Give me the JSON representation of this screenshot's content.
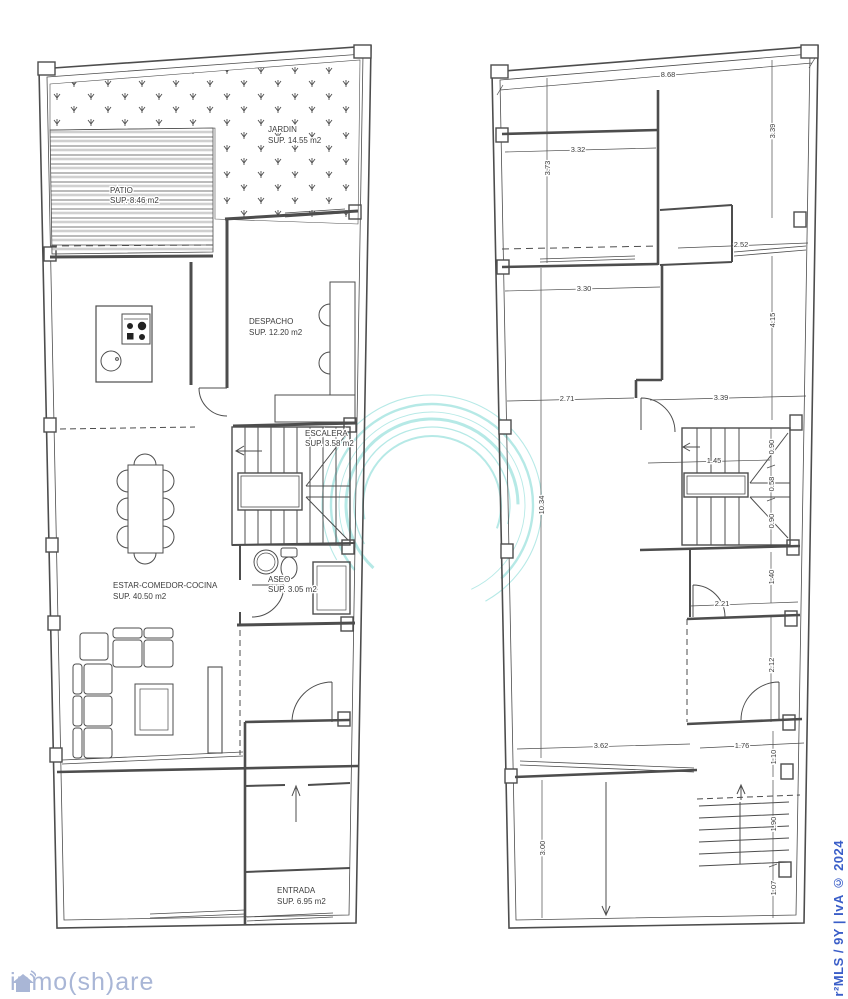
{
  "sheet": {
    "background": "#ffffff"
  },
  "branding": {
    "logo_text": "inmo(sh)are",
    "logo_color": "#a9b6d6",
    "credit_text": "r²MLS / 9Y | IvA © 2024",
    "credit_color": "#3a5ec8",
    "swirl_color": "#6fd4cf"
  },
  "ground_floor": {
    "rooms": {
      "patio": {
        "name": "PATIO",
        "area": "SUP. 8.46 m2"
      },
      "jardin": {
        "name": "JARDIN",
        "area": "SUP. 14.55 m2"
      },
      "despacho": {
        "name": "DESPACHO",
        "area": "SUP. 12.20 m2"
      },
      "escalera": {
        "name": "ESCALERA",
        "area": "SUP. 3.58 m2"
      },
      "aseo": {
        "name": "ASEO",
        "area": "SUP. 3.05 m2"
      },
      "estar": {
        "name": "ESTAR-COMEDOR-COCINA",
        "area": "SUP. 40.50 m2"
      },
      "entrada": {
        "name": "ENTRADA",
        "area": "SUP. 6.95 m2"
      }
    }
  },
  "upper_floor": {
    "dims": {
      "top_width": "8.68",
      "d373": "3.73",
      "d332": "3.32",
      "d339a": "3.39",
      "d252": "2.52",
      "d330": "3.30",
      "d415": "4.15",
      "d271": "2.71",
      "d339b": "3.39",
      "d1034": "10.34",
      "d145": "1.45",
      "d090a": "0.90",
      "d058": "0.58",
      "d090b": "0.90",
      "d140": "1.40",
      "d221": "2.21",
      "d212": "2.12",
      "d362": "3.62",
      "d176": "1.76",
      "d110": "1.10",
      "d300": "3.00",
      "d190": "1.90",
      "d107": "1.07"
    }
  }
}
